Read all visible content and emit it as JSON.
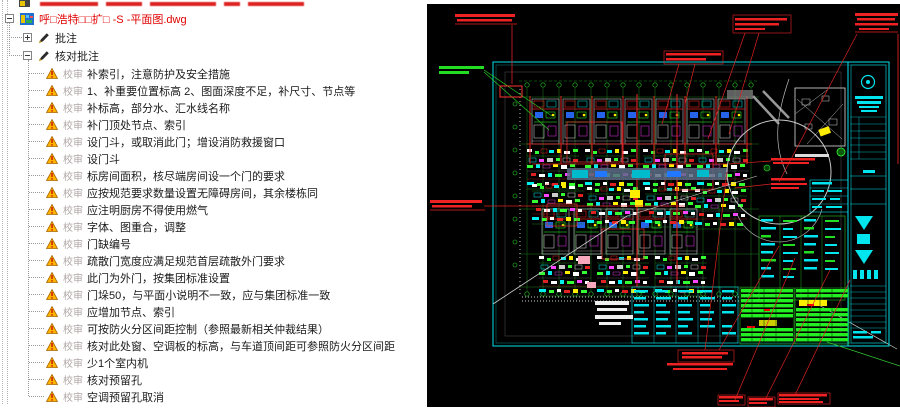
{
  "tree": {
    "file_name": "呼□浩特□□扩□ -S -平面图.dwg",
    "node_annotations": "批注",
    "node_check_annotations": "核对批注",
    "status_prefix": "校审",
    "items": [
      "补索引，注意防护及安全措施",
      "1、补重要位置标高 2、图面深度不足，补尺寸、节点等",
      "补标高，部分水、汇水线名称",
      "补门顶处节点、索引",
      "设门斗，或取消此门；增设消防救援窗口",
      "设门斗",
      "标房间面积，核尽端房间设一个门的要求",
      "应按规范要求数量设置无障碍房间，其余楼栋同",
      "应注明厨房不得使用燃气",
      "字体、图重合，调整",
      "门缺编号",
      "疏散门宽度应满足规范首层疏散外门要求",
      "此门为外门，按集团标准设置",
      "门垛50，与平面小说明不一致，应与集团标准一致",
      "应增加节点、索引",
      "可按防火分区间距控制（参照最新相关仲裁结果）",
      "核对此处窗、空调板的标高，与车道顶间距可参照防火分区间距",
      "少1个室内机",
      "核对预留孔",
      "空调预留孔取消"
    ]
  },
  "cad": {
    "background": "#000000",
    "frame_color": "#00e5ee",
    "annotation_red": "#ff2222",
    "annotation_green": "#33ff33",
    "grid_green": "#1d7d1d",
    "highlight_yellow": "#ffee00"
  }
}
